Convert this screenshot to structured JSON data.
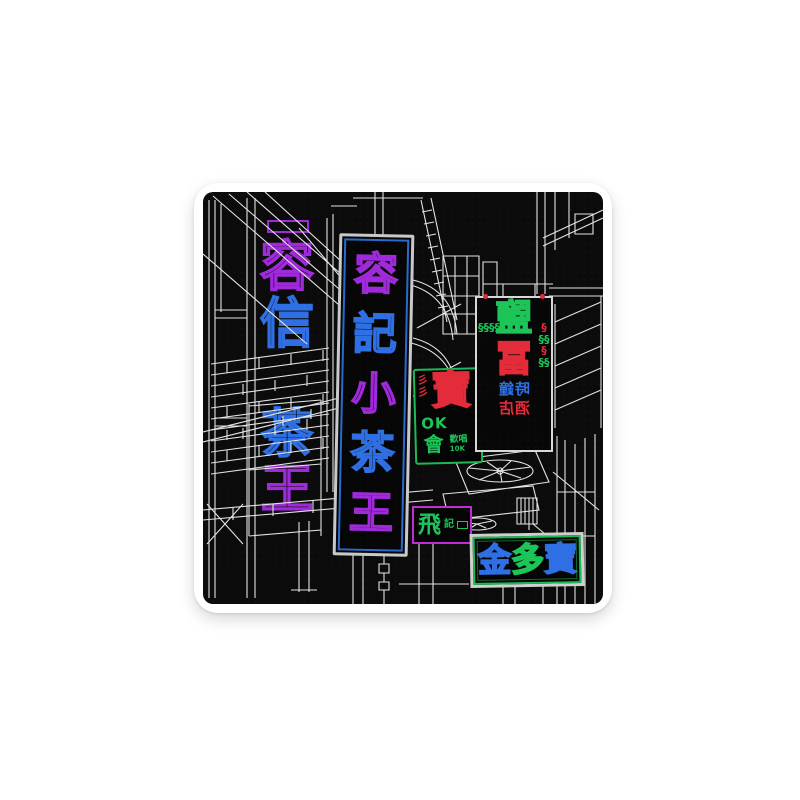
{
  "page": {
    "background": "#ffffff"
  },
  "sticker": {
    "type": "die-cut-sticker",
    "subject": "Hong Kong street alley with neon shop signs, white line art on black",
    "border_color": "#ffffff",
    "art_background": "#0b0b0b",
    "line_color": "#e3e3e3",
    "palette": {
      "purple": "#a02adb",
      "blue": "#2e6fe3",
      "green": "#1cc558",
      "red": "#e42b3a",
      "frame_blue": "#2a6ad0",
      "frame_green": "#1db954",
      "frame_purple": "#c12cd6",
      "frame_white": "#cfcfcf"
    },
    "signs": {
      "left_upper": {
        "chars": [
          {
            "t": "容",
            "color": "purple"
          },
          {
            "t": "信",
            "color": "blue"
          }
        ]
      },
      "left_lower": {
        "chars": [
          {
            "t": "茶",
            "color": "blue"
          },
          {
            "t": "王",
            "color": "purple"
          }
        ]
      },
      "main_vertical": {
        "frame": "frame_blue",
        "chars": [
          {
            "t": "容",
            "color": "purple"
          },
          {
            "t": "記",
            "color": "blue"
          },
          {
            "t": "小",
            "color": "purple"
          },
          {
            "t": "茶",
            "color": "blue"
          },
          {
            "t": "王",
            "color": "purple"
          }
        ]
      },
      "karaoke": {
        "frame": "frame_green",
        "big": "寶",
        "big_color": "red",
        "squiggle": "彡彡",
        "squiggle_color": "red",
        "line2": "OK",
        "line2_color": "green",
        "line3": "會",
        "line3_color": "green",
        "side": "歡唱",
        "small": "10K",
        "side_color": "green"
      },
      "hotel": {
        "mirrored": true,
        "row1": "鹽",
        "row1_color": "green",
        "row2": "冨",
        "row2_color": "red",
        "row3": "時鐘",
        "row3_color": "blue",
        "row4": "酒店",
        "row4_color": "red",
        "chain_left": "§§§§§",
        "chain_right_top": "§",
        "chain_right_mid": "§§",
        "chain_right_low": "§§"
      },
      "small_purple": {
        "frame": "frame_purple",
        "main": "飛",
        "main_color": "green",
        "side": "記",
        "side_color": "green"
      },
      "bottom_green": {
        "frame": "frame_green",
        "chars": [
          {
            "t": "金",
            "color": "blue"
          },
          {
            "t": "多",
            "color": "green"
          },
          {
            "t": "寶",
            "color": "blue"
          }
        ]
      }
    }
  }
}
